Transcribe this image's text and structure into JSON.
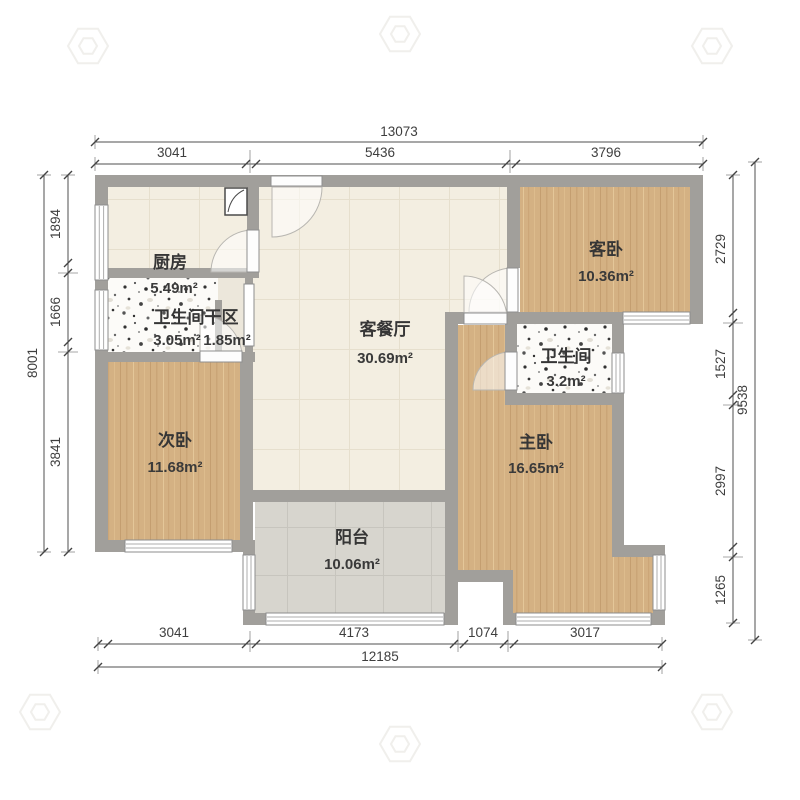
{
  "rooms": {
    "kitchen": {
      "name": "厨房",
      "area": "5.49m²"
    },
    "bath_dry": {
      "name": "卫生间干区",
      "area_a": "3.05m²",
      "area_b": "1.85m²"
    },
    "living": {
      "name": "客餐厅",
      "area": "30.69m²"
    },
    "guest_bed": {
      "name": "客卧",
      "area": "10.36m²"
    },
    "bathroom": {
      "name": "卫生间",
      "area": "3.2m²"
    },
    "second_bed": {
      "name": "次卧",
      "area": "11.68m²"
    },
    "master_bed": {
      "name": "主卧",
      "area": "16.65m²"
    },
    "balcony": {
      "name": "阳台",
      "area": "10.06m²"
    }
  },
  "dims": {
    "top": {
      "total": "13073",
      "segments": [
        "3041",
        "5436",
        "3796"
      ]
    },
    "bottom": {
      "total": "12185",
      "segments": [
        "3041",
        "4173",
        "1074",
        "3017"
      ]
    },
    "left": {
      "total": "8001",
      "segments": [
        "1894",
        "1666",
        "3841"
      ]
    },
    "right": {
      "total": "9538",
      "segments": [
        "2729",
        "1527",
        "2997",
        "1265"
      ]
    }
  },
  "colors": {
    "wall": "#a19f9b",
    "wood": "#d4b183",
    "tile": "#f3eee1",
    "balcony_floor": "#d7d5ce",
    "speckle_bg": "#fcfbf8",
    "vestibule": "#ece7db"
  }
}
